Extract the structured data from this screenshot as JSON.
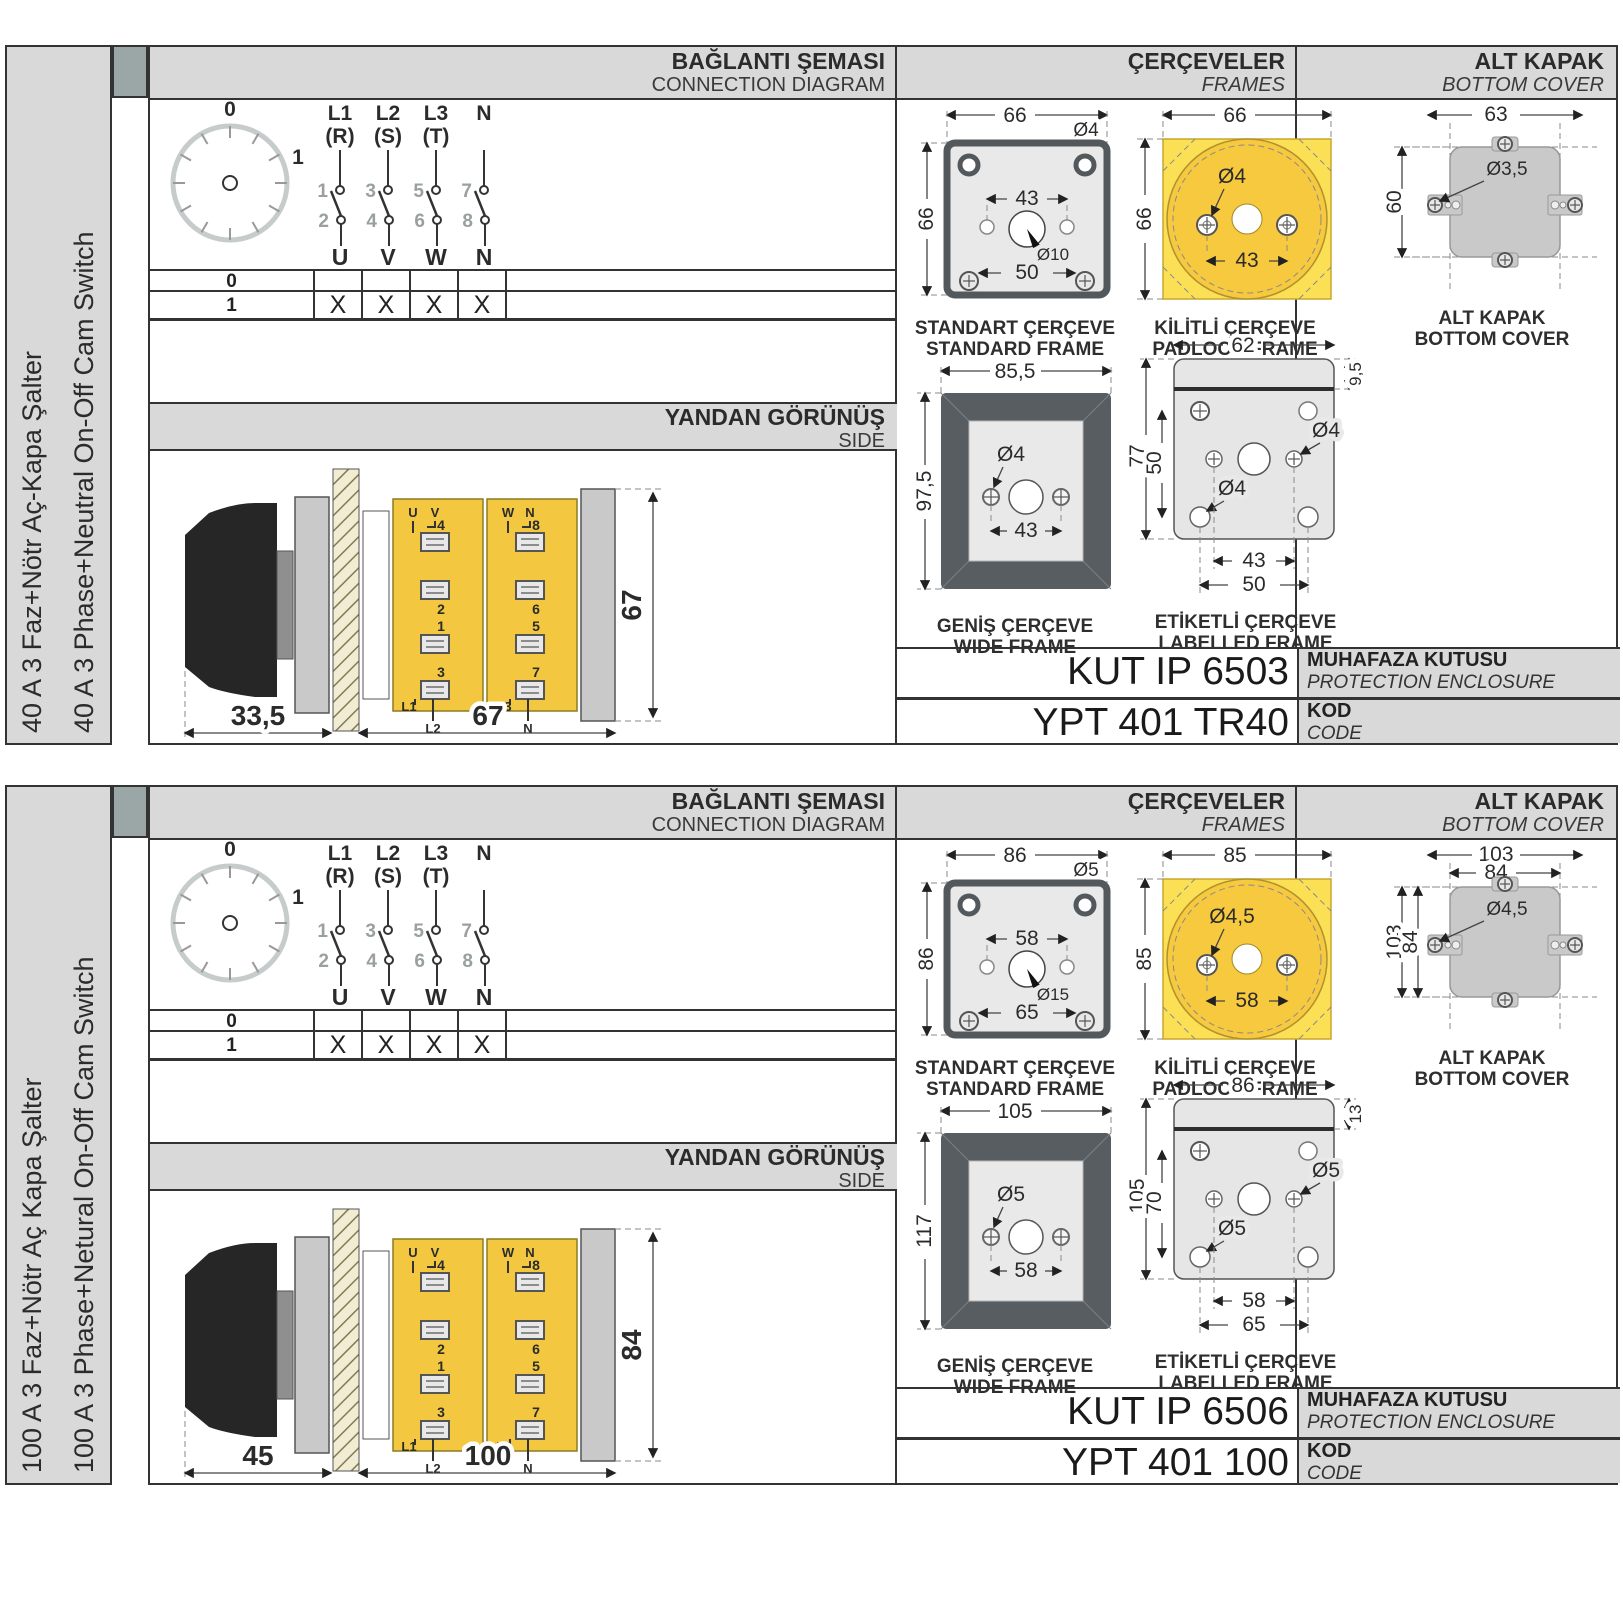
{
  "sections": [
    {
      "side_labels": {
        "tr": "40 A 3 Faz+Nötr Aç-Kapa Şalter",
        "en": "40 A 3 Phase+Neutral On-Off Cam Switch"
      },
      "headers": {
        "connection_tr": "BAĞLANTI ŞEMASI",
        "connection_en": "CONNECTION DIAGRAM",
        "frames_tr": "ÇERÇEVELER",
        "frames_en": "FRAMES",
        "cover_tr": "ALT KAPAK",
        "cover_en": "BOTTOM COVER"
      },
      "connection": {
        "dial_pos_off": "0",
        "dial_pos_on": "1",
        "columns": [
          {
            "line": "L1",
            "phase": "(R)",
            "c_in": "1",
            "c_out": "2",
            "out": "U"
          },
          {
            "line": "L2",
            "phase": "(S)",
            "c_in": "3",
            "c_out": "4",
            "out": "V"
          },
          {
            "line": "L3",
            "phase": "(T)",
            "c_in": "5",
            "c_out": "6",
            "out": "W"
          },
          {
            "line": "N",
            "phase": "",
            "c_in": "7",
            "c_out": "8",
            "out": "N"
          }
        ],
        "rows": [
          {
            "label": "0",
            "marks": [
              "",
              "",
              "",
              ""
            ]
          },
          {
            "label": "1",
            "marks": [
              "X",
              "X",
              "X",
              "X"
            ]
          }
        ]
      },
      "side_view": {
        "title_tr": "YANDAN GÖRÜNÜŞ",
        "title_en": "SIDE",
        "dim_handle": "33,5",
        "dim_body": "67",
        "dim_height": "67",
        "terminals": {
          "left": {
            "top1": "U",
            "top2": "V",
            "t1": "4",
            "t2": "2",
            "t3": "1",
            "t4": "3",
            "bot1": "L1",
            "bot2": "L2"
          },
          "right": {
            "top1": "W",
            "top2": "N",
            "t1": "8",
            "t2": "6",
            "t3": "5",
            "t4": "7",
            "bot1": "L3",
            "bot2": "N"
          }
        }
      },
      "frames": {
        "standard": {
          "label_tr": "STANDART ÇERÇEVE",
          "label_en": "STANDARD FRAME",
          "dim_width": "66",
          "dim_height": "66",
          "dim_hole": "Ø4",
          "dim_holes_span": "43",
          "dim_center_hole": "Ø10",
          "dim_bottom": "50"
        },
        "padlock": {
          "label_tr": "KİLİTLİ ÇERÇEVE",
          "label_en": "PADLOCK FRAME",
          "dim_width": "66",
          "dim_height": "66",
          "dim_hole": "Ø4",
          "dim_holes_span": "43"
        },
        "wide": {
          "label_tr": "GENİŞ ÇERÇEVE",
          "label_en": "WIDE FRAME",
          "dim_width": "85,5",
          "dim_height": "97,5",
          "dim_hole": "Ø4",
          "dim_holes_span": "43"
        },
        "labelled": {
          "label_tr": "ETİKETLİ ÇERÇEVE",
          "label_en": "LABELLED FRAME",
          "dim_width": "62",
          "dim_strip": "9,5",
          "dim_height": "77",
          "dim_inner_height": "50",
          "dim_hole_right": "Ø4",
          "dim_hole_left": "Ø4",
          "dim_holes_span": "43",
          "dim_bottom": "50"
        }
      },
      "cover": {
        "label_tr": "ALT KAPAK",
        "label_en": "BOTTOM COVER",
        "dim_width_outer": "63",
        "dim_width_inner": "",
        "dim_hole": "Ø3,5",
        "dim_height_outer": "60",
        "dim_height_inner": ""
      },
      "codes": {
        "enclosure_value": "KUT IP 6503",
        "enclosure_tr": "MUHAFAZA KUTUSU",
        "enclosure_en": "PROTECTION ENCLOSURE",
        "code_value": "YPT 401 TR40",
        "code_tr": "KOD",
        "code_en": "CODE"
      }
    },
    {
      "side_labels": {
        "tr": "100 A 3 Faz+Nötr Aç Kapa Şalter",
        "en": "100 A 3 Phase+Netural On-Off Cam Switch"
      },
      "headers": {
        "connection_tr": "BAĞLANTI ŞEMASI",
        "connection_en": "CONNECTION DIAGRAM",
        "frames_tr": "ÇERÇEVELER",
        "frames_en": "FRAMES",
        "cover_tr": "ALT KAPAK",
        "cover_en": "BOTTOM COVER"
      },
      "connection": {
        "dial_pos_off": "0",
        "dial_pos_on": "1",
        "columns": [
          {
            "line": "L1",
            "phase": "(R)",
            "c_in": "1",
            "c_out": "2",
            "out": "U"
          },
          {
            "line": "L2",
            "phase": "(S)",
            "c_in": "3",
            "c_out": "4",
            "out": "V"
          },
          {
            "line": "L3",
            "phase": "(T)",
            "c_in": "5",
            "c_out": "6",
            "out": "W"
          },
          {
            "line": "N",
            "phase": "",
            "c_in": "7",
            "c_out": "8",
            "out": "N"
          }
        ],
        "rows": [
          {
            "label": "0",
            "marks": [
              "",
              "",
              "",
              ""
            ]
          },
          {
            "label": "1",
            "marks": [
              "X",
              "X",
              "X",
              "X"
            ]
          }
        ]
      },
      "side_view": {
        "title_tr": "YANDAN GÖRÜNÜŞ",
        "title_en": "SIDE",
        "dim_handle": "45",
        "dim_body": "100",
        "dim_height": "84",
        "terminals": {
          "left": {
            "top1": "U",
            "top2": "V",
            "t1": "4",
            "t2": "2",
            "t3": "1",
            "t4": "3",
            "bot1": "L1",
            "bot2": "L2"
          },
          "right": {
            "top1": "W",
            "top2": "N",
            "t1": "8",
            "t2": "6",
            "t3": "5",
            "t4": "7",
            "bot1": "L3",
            "bot2": "N"
          }
        }
      },
      "frames": {
        "standard": {
          "label_tr": "STANDART ÇERÇEVE",
          "label_en": "STANDARD FRAME",
          "dim_width": "86",
          "dim_height": "86",
          "dim_hole": "Ø5",
          "dim_holes_span": "58",
          "dim_center_hole": "Ø15",
          "dim_bottom": "65"
        },
        "padlock": {
          "label_tr": "KİLİTLİ ÇERÇEVE",
          "label_en": "PADLOCK FRAME",
          "dim_width": "85",
          "dim_height": "85",
          "dim_hole": "Ø4,5",
          "dim_holes_span": "58"
        },
        "wide": {
          "label_tr": "GENİŞ ÇERÇEVE",
          "label_en": "WIDE FRAME",
          "dim_width": "105",
          "dim_height": "117",
          "dim_hole": "Ø5",
          "dim_holes_span": "58"
        },
        "labelled": {
          "label_tr": "ETİKETLİ ÇERÇEVE",
          "label_en": "LABELLED FRAME",
          "dim_width": "86",
          "dim_strip": "13",
          "dim_height": "105",
          "dim_inner_height": "70",
          "dim_hole_right": "Ø5",
          "dim_hole_left": "Ø5",
          "dim_holes_span": "58",
          "dim_bottom": "65"
        }
      },
      "cover": {
        "label_tr": "ALT KAPAK",
        "label_en": "BOTTOM COVER",
        "dim_width_outer": "103",
        "dim_width_inner": "84",
        "dim_hole": "Ø4,5",
        "dim_height_outer": "103",
        "dim_height_inner": "84"
      },
      "codes": {
        "enclosure_value": "KUT IP 6506",
        "enclosure_tr": "MUHAFAZA KUTUSU",
        "enclosure_en": "PROTECTION ENCLOSURE",
        "code_value": "YPT 401 100",
        "code_tr": "KOD",
        "code_en": "CODE"
      }
    }
  ]
}
